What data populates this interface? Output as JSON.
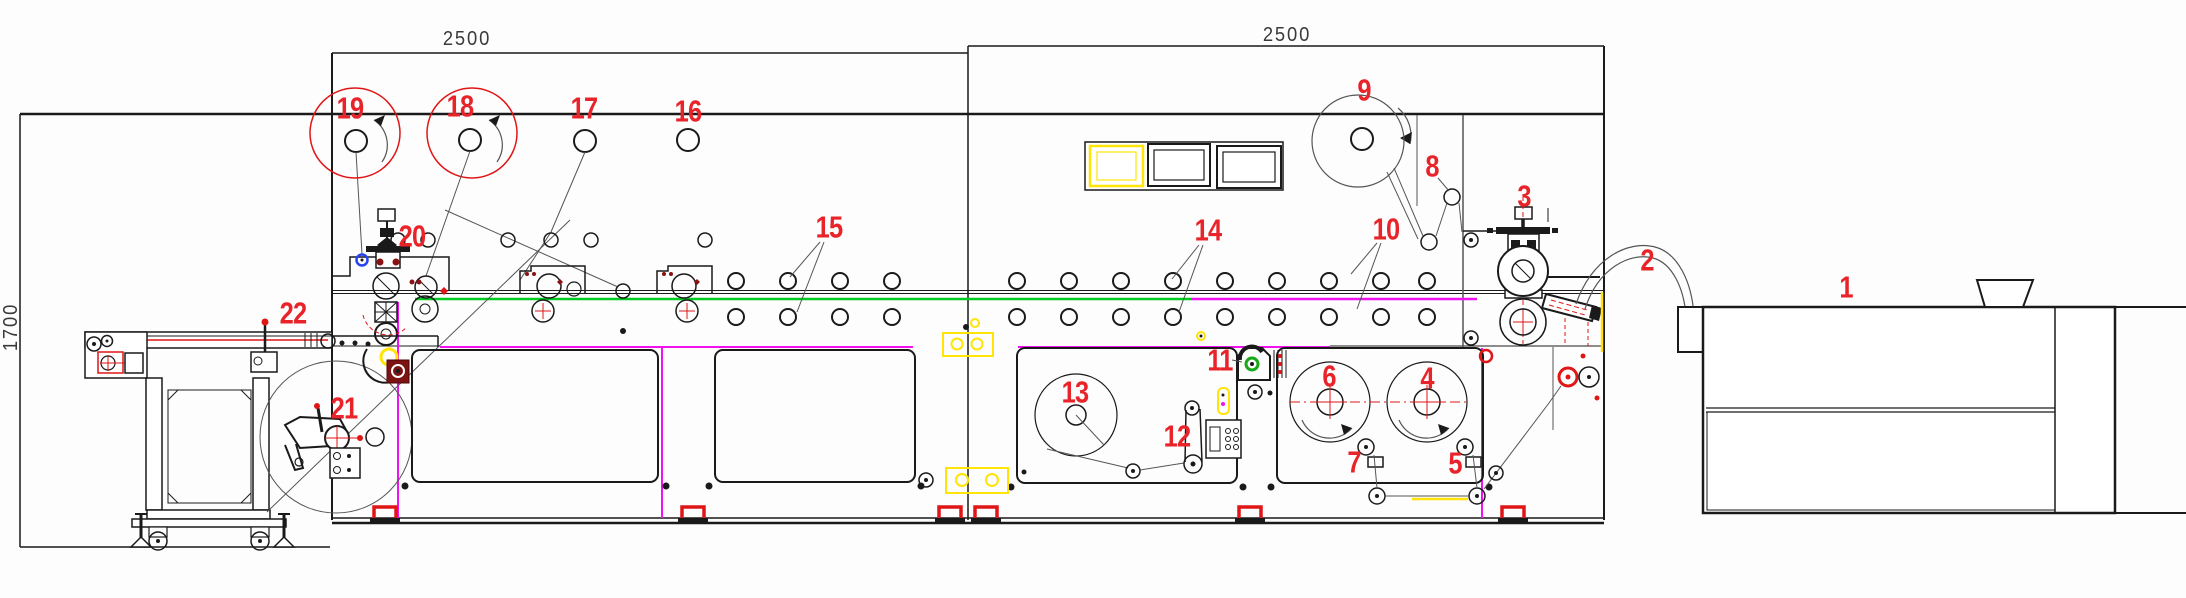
{
  "drawing": {
    "kind": "packaging-machine-line CAD layout",
    "dimension_labels": {
      "left_module_width": "2500",
      "right_module_width": "2500",
      "outfeed_height": "1700"
    },
    "colors": {
      "label_red": "#e8232a",
      "web_green": "#00cc22",
      "magenta": "#f012f0",
      "yellow": "#ffe405",
      "accent_red": "#e01616",
      "blue": "#2743f0",
      "line": "#1a1a1a"
    },
    "part_labels": [
      {
        "num": "1",
        "x": 1846,
        "y": 287
      },
      {
        "num": "2",
        "x": 1647,
        "y": 260
      },
      {
        "num": "3",
        "x": 1524,
        "y": 196
      },
      {
        "num": "4",
        "x": 1427,
        "y": 378
      },
      {
        "num": "5",
        "x": 1455,
        "y": 463
      },
      {
        "num": "6",
        "x": 1329,
        "y": 376
      },
      {
        "num": "7",
        "x": 1354,
        "y": 462
      },
      {
        "num": "8",
        "x": 1432,
        "y": 166
      },
      {
        "num": "9",
        "x": 1364,
        "y": 90
      },
      {
        "num": "10",
        "x": 1386,
        "y": 229
      },
      {
        "num": "11",
        "x": 1220,
        "y": 360
      },
      {
        "num": "12",
        "x": 1177,
        "y": 436
      },
      {
        "num": "13",
        "x": 1075,
        "y": 392
      },
      {
        "num": "14",
        "x": 1208,
        "y": 230
      },
      {
        "num": "15",
        "x": 829,
        "y": 227
      },
      {
        "num": "16",
        "x": 688,
        "y": 111
      },
      {
        "num": "17",
        "x": 584,
        "y": 108
      },
      {
        "num": "18",
        "x": 460,
        "y": 106
      },
      {
        "num": "19",
        "x": 350,
        "y": 108
      },
      {
        "num": "20",
        "x": 412,
        "y": 236
      },
      {
        "num": "21",
        "x": 344,
        "y": 408
      },
      {
        "num": "22",
        "x": 293,
        "y": 313
      }
    ]
  }
}
